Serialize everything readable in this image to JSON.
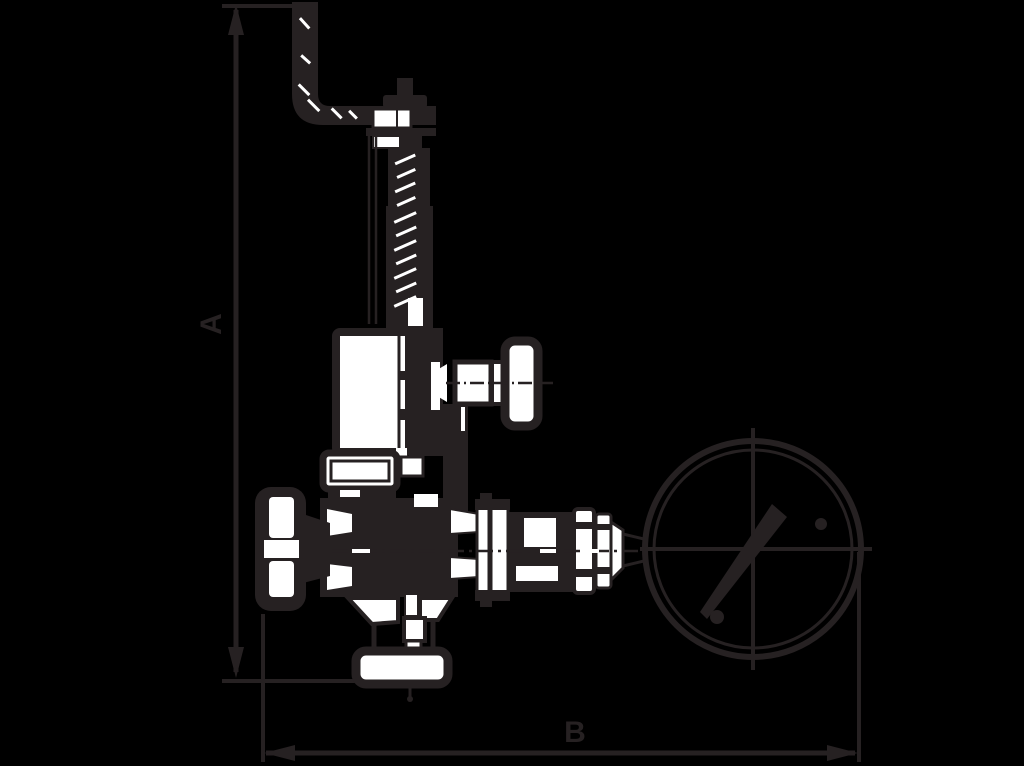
{
  "diagram": {
    "type": "technical-dimension-drawing",
    "subject": "Safety relief valve with lift lever, handwheel and pressure gauge - side elevation with overall dimensions",
    "dimensions": {
      "vertical": {
        "label": "A",
        "measures": "overall height from lever bracket top to outlet flange bottom"
      },
      "horizontal": {
        "label": "B",
        "measures": "overall width from handwheel to pressure gauge rim"
      }
    },
    "parts": [
      "lift-lever-bracket",
      "spindle-cap-nuts",
      "threaded-spindle",
      "spring-bonnet",
      "test-knob",
      "bonnet-collar",
      "valve-body",
      "handwheel",
      "outlet-flange",
      "flange-connection",
      "hex-coupling",
      "gauge-adapter",
      "pressure-gauge"
    ],
    "colors": {
      "background": "#000000",
      "line": "#262122",
      "fill": "#ffffff"
    }
  }
}
